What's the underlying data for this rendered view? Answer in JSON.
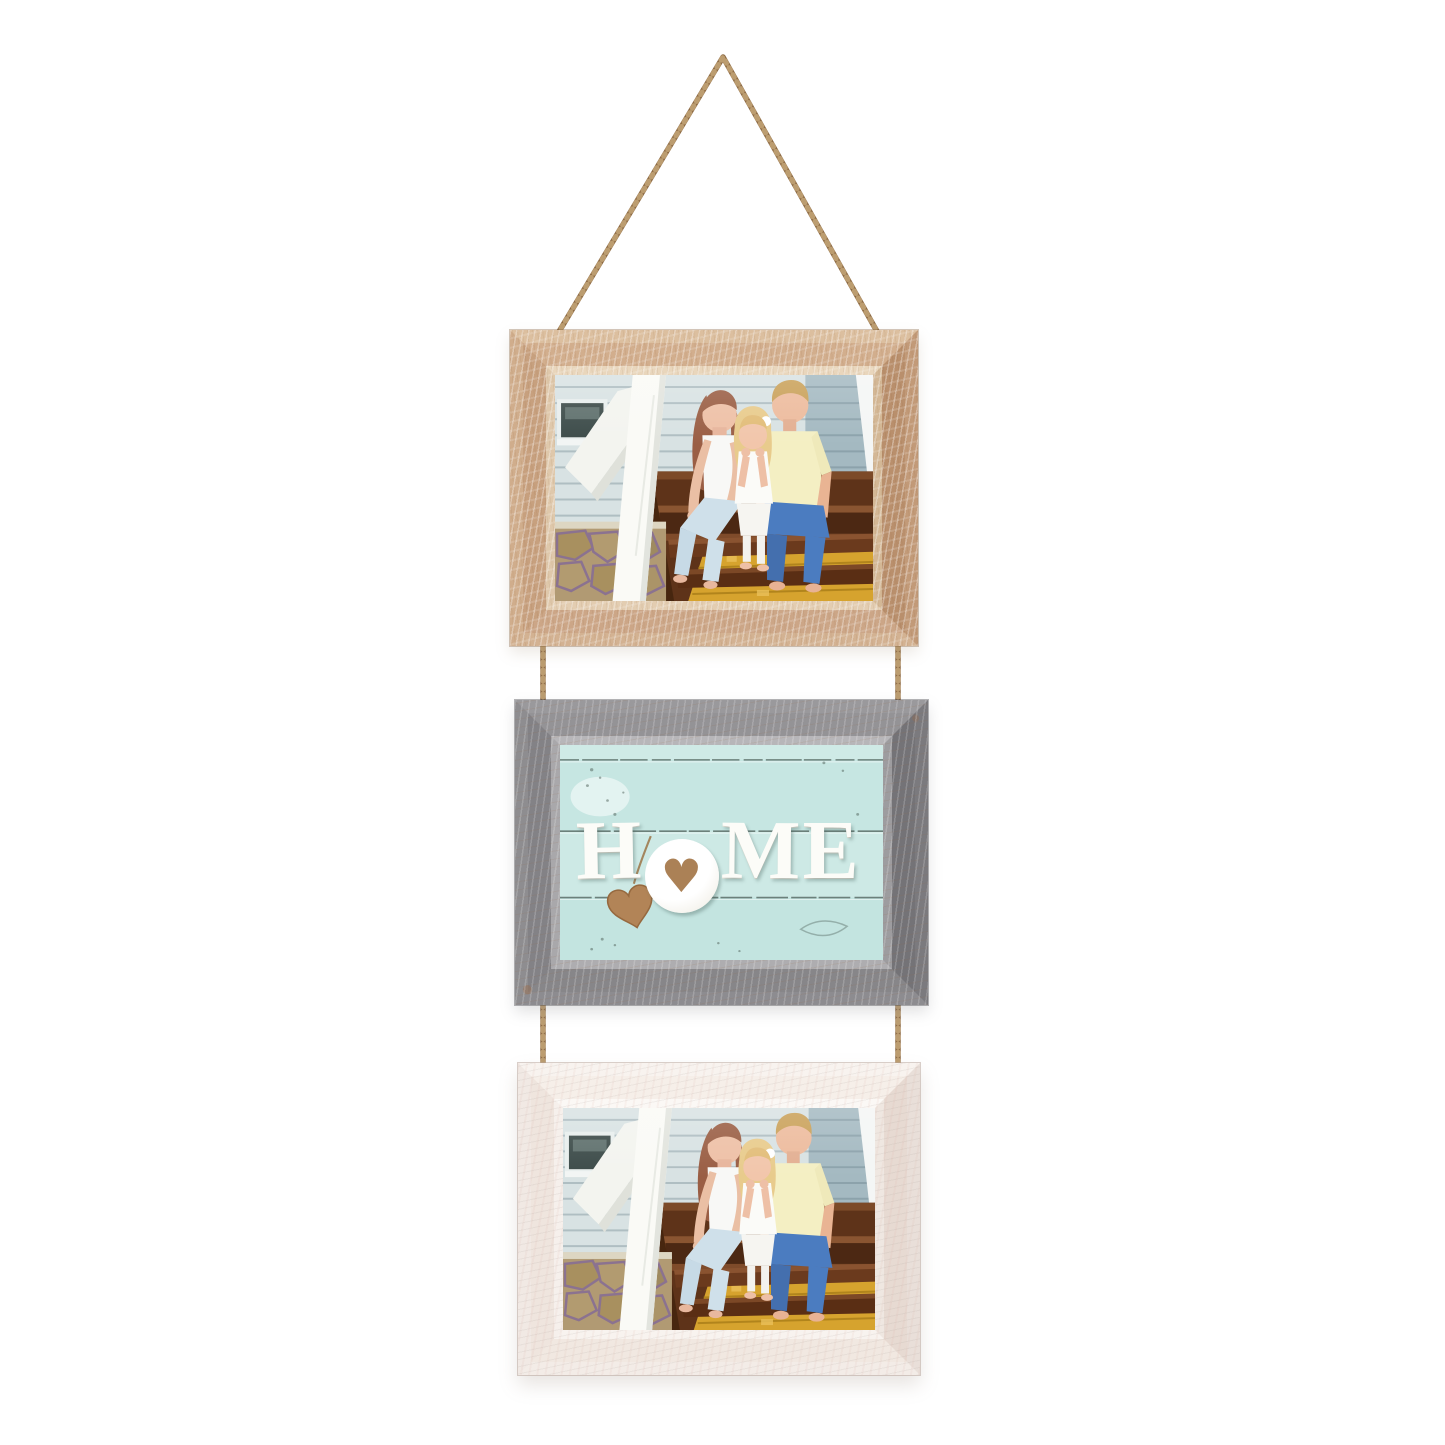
{
  "scene": {
    "name": "three-frame hanging photo set on jute rope",
    "background_color": "#ffffff"
  },
  "rope": {
    "name": "jute-twine-rope",
    "color": "#8d6a44",
    "highlight_color": "#c4a678"
  },
  "frames": {
    "top": {
      "style": "distressed-natural-wood",
      "face_color": "#c7a07e",
      "content": "family-photo"
    },
    "middle": {
      "style": "distressed-gray-wood",
      "face_color": "#87868a",
      "content": "home-sign"
    },
    "bottom": {
      "style": "distressed-white-wood",
      "face_color": "#efe5de",
      "content": "family-photo"
    }
  },
  "home_sign": {
    "word": "HOME",
    "letters": [
      "H",
      "O",
      "M",
      "E"
    ],
    "heart_glyph": "♥",
    "letter_color": "#fcfcf8",
    "panel_color": "#c9e8e4",
    "o_heart_color": "#ab8156",
    "hanging_heart_color": "#b28457"
  },
  "photo": {
    "name": "family-on-porch-steps",
    "people": [
      "mother",
      "daughter",
      "father"
    ],
    "siding_color": "#d8e2e3",
    "steps_color": "#5e3319",
    "rug_color": "#d6a32e"
  }
}
